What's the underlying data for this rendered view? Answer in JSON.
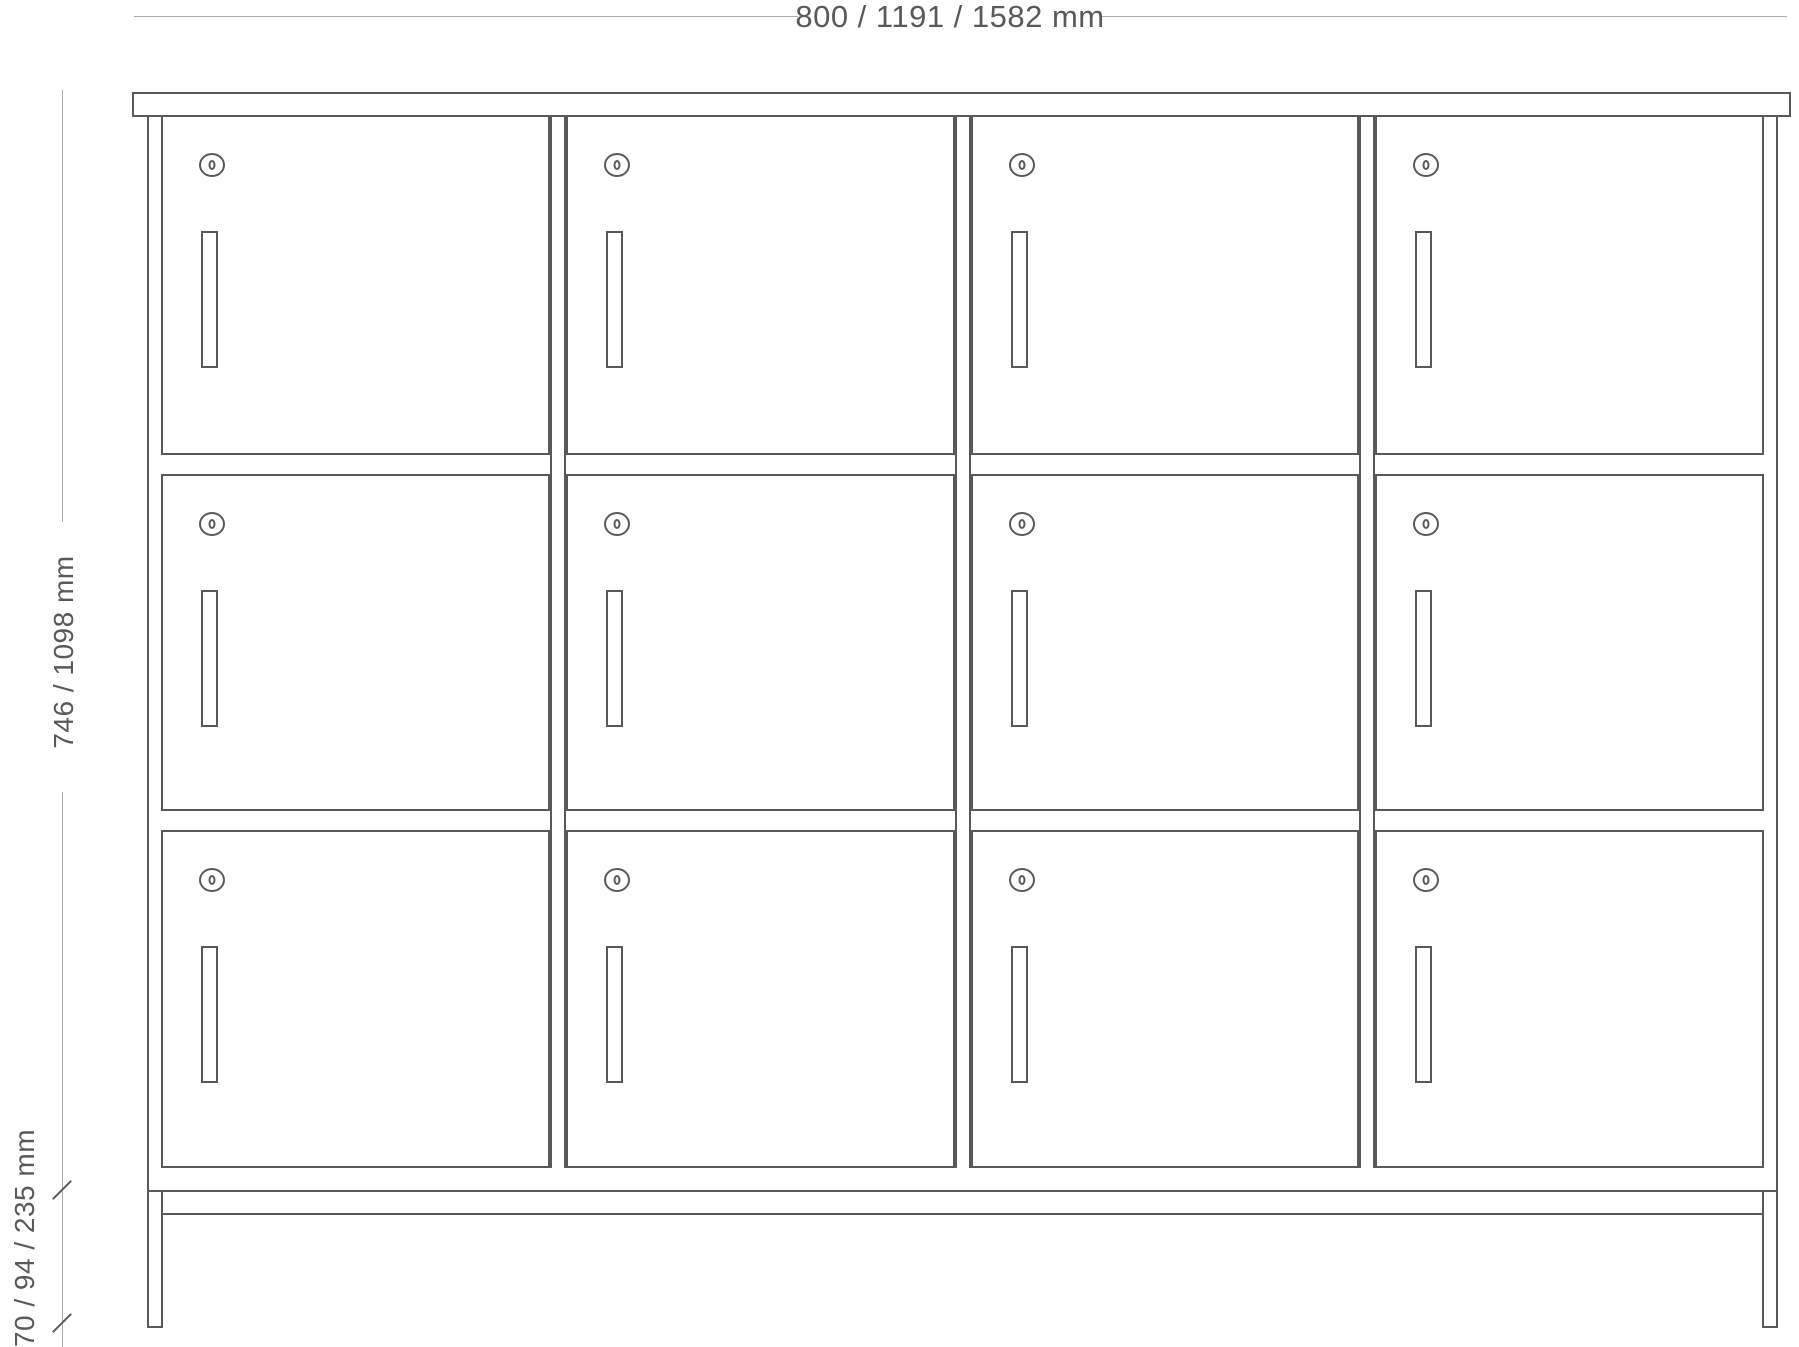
{
  "drawing": {
    "title": "locker cabinet technical drawing",
    "dimension_labels": {
      "width": "800 / 1191 / 1582 mm",
      "height": "746 / 1098 mm",
      "base_height": "70 / 94 / 235 mm"
    }
  },
  "cabinet": {
    "columns": 4,
    "rows": 3,
    "compartments": 12
  },
  "icons": {
    "lock": "keyhole-lock-icon",
    "handle": "door-handle"
  },
  "colors": {
    "outline": "#58595b",
    "dimension_line": "#ababab",
    "label_text": "#58595b",
    "background": "#ffffff"
  }
}
